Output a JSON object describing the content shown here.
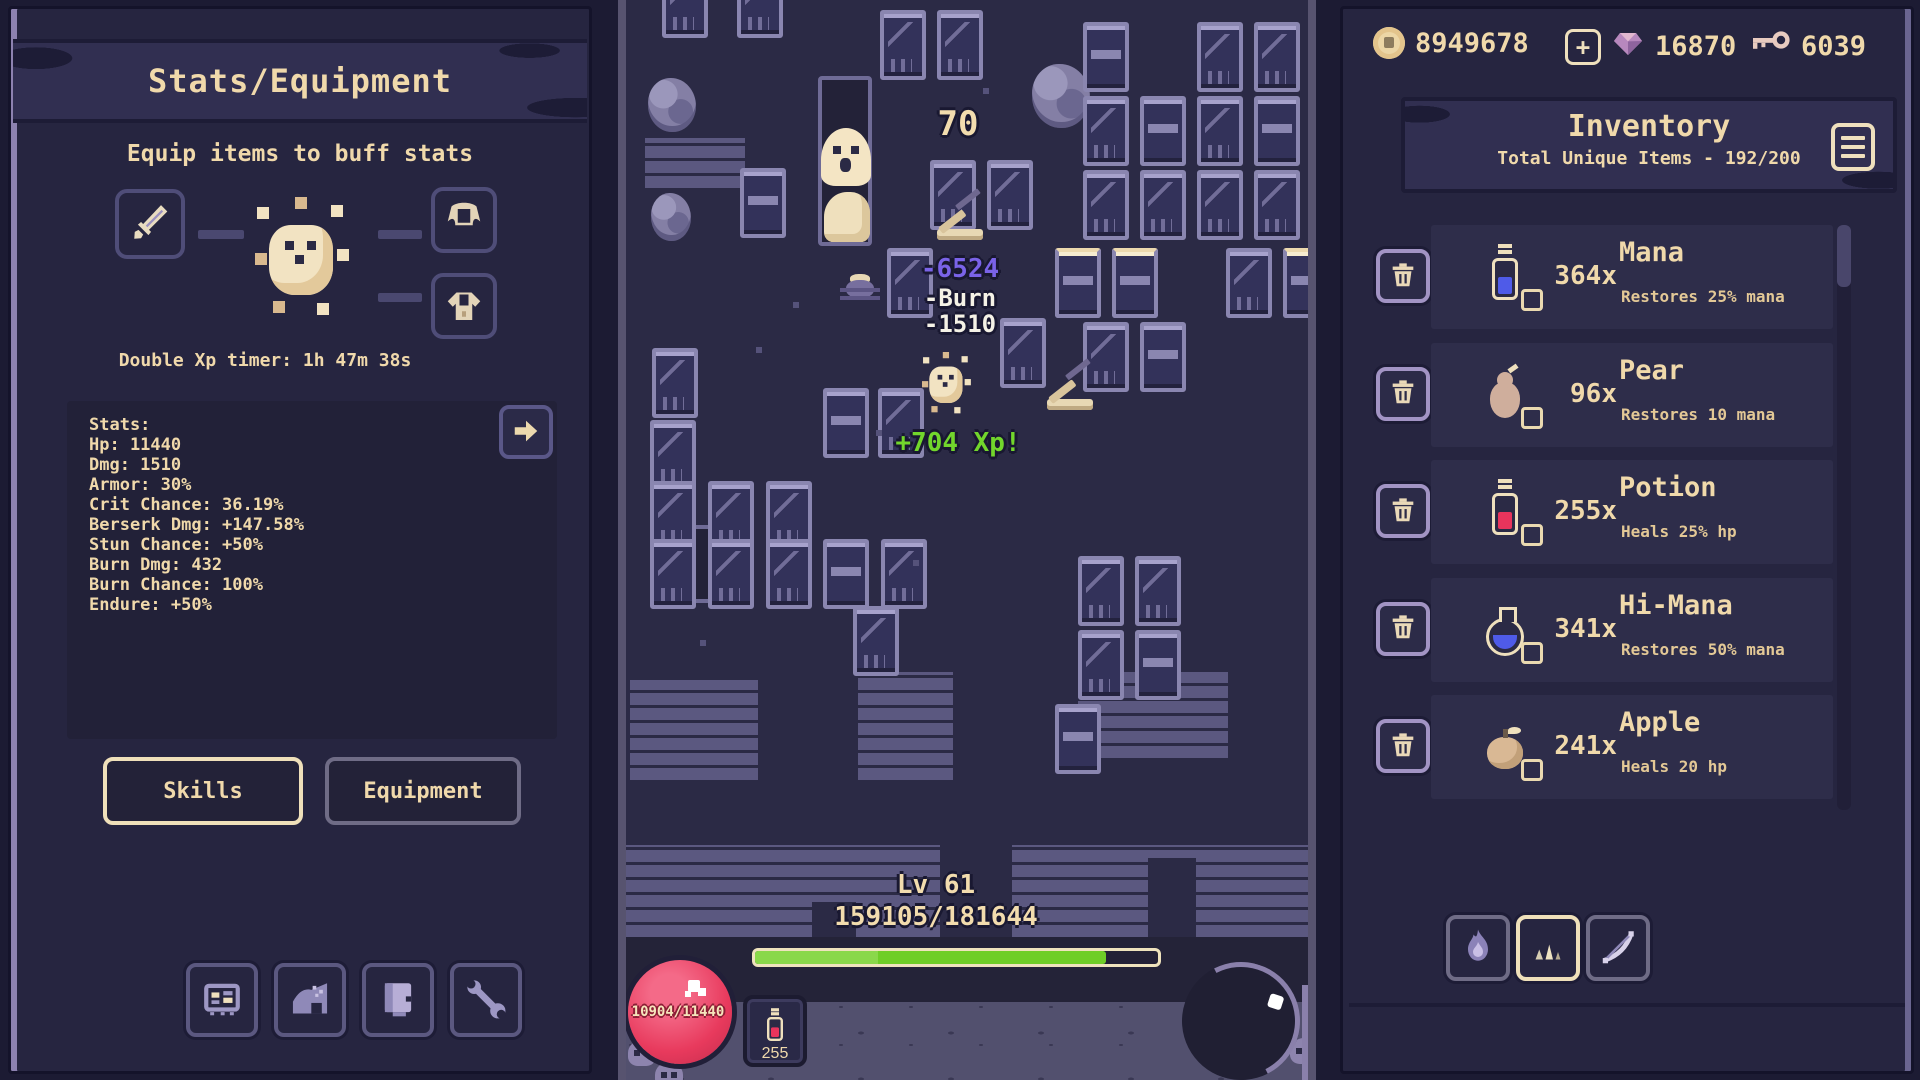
{
  "left_panel": {
    "title": "Stats/Equipment",
    "subtitle": "Equip items to buff stats",
    "double_xp_timer": "Double Xp timer: 1h 47m 38s",
    "stats_lines": [
      "Stats:",
      "Hp: 11440",
      "Dmg: 1510",
      "Armor: 30%",
      "Crit Chance: 36.19%",
      "Berserk Dmg: +147.58%",
      "Stun Chance: +50%",
      "Burn Dmg: 432",
      "Burn Chance: 100%",
      "Endure: +50%"
    ],
    "tabs": {
      "skills": "Skills",
      "equipment": "Equipment"
    },
    "equipment_slots": [
      "sword",
      "cape",
      "armor"
    ],
    "dock_buttons": [
      "stats-board",
      "cave",
      "journal",
      "wrench"
    ]
  },
  "game": {
    "level": "Lv 61",
    "xp_text": "159105/181644",
    "xp_percent": 87,
    "hp_text": "10904/11440",
    "potion_count": "255",
    "floats": [
      {
        "text": "70",
        "x": 332,
        "y": 104,
        "cls": "big"
      },
      {
        "text": "-6524",
        "x": 334,
        "y": 254,
        "cls": "crit"
      },
      {
        "text": "-Burn",
        "x": 334,
        "y": 284,
        "cls": "plain"
      },
      {
        "text": "-1510",
        "x": 334,
        "y": 310,
        "cls": "plain"
      },
      {
        "text": "+704 Xp!",
        "x": 332,
        "y": 428,
        "cls": "xp"
      }
    ]
  },
  "right_panel": {
    "currencies": [
      {
        "icon": "coin-icon",
        "value": "8949678"
      },
      {
        "icon": "gem-icon",
        "value": "16870"
      },
      {
        "icon": "key-icon",
        "value": "6039"
      }
    ],
    "inventory": {
      "title": "Inventory",
      "subtitle": "Total Unique Items - 192/200",
      "items": [
        {
          "icon": "mana-potion",
          "count": "364x",
          "name": "Mana",
          "desc": "Restores 25% mana"
        },
        {
          "icon": "pear",
          "count": "96x",
          "name": "Pear",
          "desc": "Restores 10 mana"
        },
        {
          "icon": "health-potion",
          "count": "255x",
          "name": "Potion",
          "desc": "Heals 25% hp"
        },
        {
          "icon": "hi-mana",
          "count": "341x",
          "name": "Hi-Mana",
          "desc": "Restores 50% mana"
        },
        {
          "icon": "apple",
          "count": "241x",
          "name": "Apple",
          "desc": "Heals 20 hp"
        }
      ]
    },
    "filters": [
      "flame",
      "spikes",
      "bow"
    ],
    "active_filter_index": 1
  },
  "colors": {
    "panel_bg": "#262540",
    "game_bg": "#2b2a45",
    "cream_text": "#f0d9ab",
    "xp_green": "#6fce27",
    "crit_purple": "#7a63e8",
    "hp_red": "#e83a5d",
    "tile_frame": "#8a86b0",
    "banner_bg": "#312f51"
  },
  "scene": {
    "crates": [
      {
        "x": 36,
        "y": -32,
        "t": "crate"
      },
      {
        "x": 111,
        "y": -32,
        "t": "crate"
      },
      {
        "x": 254,
        "y": 10,
        "t": "crate"
      },
      {
        "x": 311,
        "y": 10,
        "t": "crate"
      },
      {
        "x": 457,
        "y": 22,
        "t": "slab"
      },
      {
        "x": 571,
        "y": 22,
        "t": "crate"
      },
      {
        "x": 628,
        "y": 22,
        "t": "crate"
      },
      {
        "x": 114,
        "y": 168,
        "t": "slab"
      },
      {
        "x": 304,
        "y": 160,
        "t": "crate"
      },
      {
        "x": 361,
        "y": 160,
        "t": "crate"
      },
      {
        "x": 457,
        "y": 96,
        "t": "crate"
      },
      {
        "x": 514,
        "y": 96,
        "t": "slab"
      },
      {
        "x": 571,
        "y": 96,
        "t": "crate"
      },
      {
        "x": 628,
        "y": 96,
        "t": "slab"
      },
      {
        "x": 457,
        "y": 170,
        "t": "crate"
      },
      {
        "x": 514,
        "y": 170,
        "t": "crate"
      },
      {
        "x": 571,
        "y": 170,
        "t": "crate"
      },
      {
        "x": 628,
        "y": 170,
        "t": "crate"
      },
      {
        "x": 261,
        "y": 248,
        "t": "crate"
      },
      {
        "x": 429,
        "y": 248,
        "t": "slab lit"
      },
      {
        "x": 486,
        "y": 248,
        "t": "slab lit"
      },
      {
        "x": 600,
        "y": 248,
        "t": "crate"
      },
      {
        "x": 657,
        "y": 248,
        "t": "slab lit"
      },
      {
        "x": 457,
        "y": 322,
        "t": "crate"
      },
      {
        "x": 514,
        "y": 322,
        "t": "slab"
      },
      {
        "x": 374,
        "y": 318,
        "t": "crate"
      },
      {
        "x": 26,
        "y": 348,
        "t": "crate"
      },
      {
        "x": 24,
        "y": 420,
        "t": "crate"
      },
      {
        "x": 197,
        "y": 388,
        "t": "slab"
      },
      {
        "x": 252,
        "y": 388,
        "t": "crate"
      },
      {
        "x": 24,
        "y": 481,
        "t": "crate"
      },
      {
        "x": 82,
        "y": 481,
        "t": "crate"
      },
      {
        "x": 140,
        "y": 481,
        "t": "crate"
      },
      {
        "x": 24,
        "y": 539,
        "t": "crate"
      },
      {
        "x": 82,
        "y": 539,
        "t": "crate"
      },
      {
        "x": 140,
        "y": 539,
        "t": "crate"
      },
      {
        "x": 197,
        "y": 539,
        "t": "slab"
      },
      {
        "x": 255,
        "y": 539,
        "t": "crate"
      },
      {
        "x": 227,
        "y": 606,
        "t": "crate"
      },
      {
        "x": 452,
        "y": 556,
        "t": "crate"
      },
      {
        "x": 509,
        "y": 556,
        "t": "crate"
      },
      {
        "x": 452,
        "y": 630,
        "t": "crate"
      },
      {
        "x": 509,
        "y": 630,
        "t": "slab"
      },
      {
        "x": 429,
        "y": 704,
        "t": "slab"
      }
    ],
    "rocks": [
      {
        "x": 22,
        "y": 78,
        "w": 48,
        "h": 54
      },
      {
        "x": 25,
        "y": 193,
        "w": 40,
        "h": 48
      },
      {
        "x": 406,
        "y": 64,
        "w": 58,
        "h": 64
      }
    ],
    "bricks": [
      {
        "x": 19,
        "y": 138,
        "w": 100,
        "h": 50
      },
      {
        "x": 4,
        "y": 680,
        "w": 128,
        "h": 100
      },
      {
        "x": 232,
        "y": 672,
        "w": 95,
        "h": 108
      },
      {
        "x": 452,
        "y": 672,
        "w": 150,
        "h": 86
      },
      {
        "x": 0,
        "y": 845,
        "w": 682,
        "h": 92
      }
    ],
    "gaps": [
      {
        "x": 314,
        "y": 845,
        "w": 72,
        "h": 92
      },
      {
        "x": 522,
        "y": 858,
        "w": 48,
        "h": 79
      },
      {
        "x": 186,
        "y": 902,
        "w": 44,
        "h": 35
      }
    ],
    "doors": [
      {
        "x": 192,
        "y": 76,
        "w": 54,
        "h": 170
      },
      {
        "x": 58,
        "y": 525,
        "w": 50,
        "h": 78
      }
    ],
    "debris": [
      {
        "x": 130,
        "y": 347
      },
      {
        "x": 167,
        "y": 302
      },
      {
        "x": 357,
        "y": 88
      },
      {
        "x": 287,
        "y": 560
      },
      {
        "x": 250,
        "y": 430
      },
      {
        "x": 74,
        "y": 640
      }
    ],
    "catapults": [
      {
        "x": 309,
        "y": 198
      },
      {
        "x": 419,
        "y": 368
      }
    ],
    "skulls": [
      {
        "x": 2,
        "y": 1040
      },
      {
        "x": 29,
        "y": 1062
      },
      {
        "x": 628,
        "y": 1028
      },
      {
        "x": 664,
        "y": 1038
      }
    ],
    "ghost": {
      "x": 195,
      "y": 128
    },
    "sand": {
      "x": 198,
      "y": 192,
      "w": 46,
      "h": 50
    },
    "spider": {
      "x": 214,
      "y": 268
    },
    "player": {
      "x": 296,
      "y": 352
    }
  }
}
